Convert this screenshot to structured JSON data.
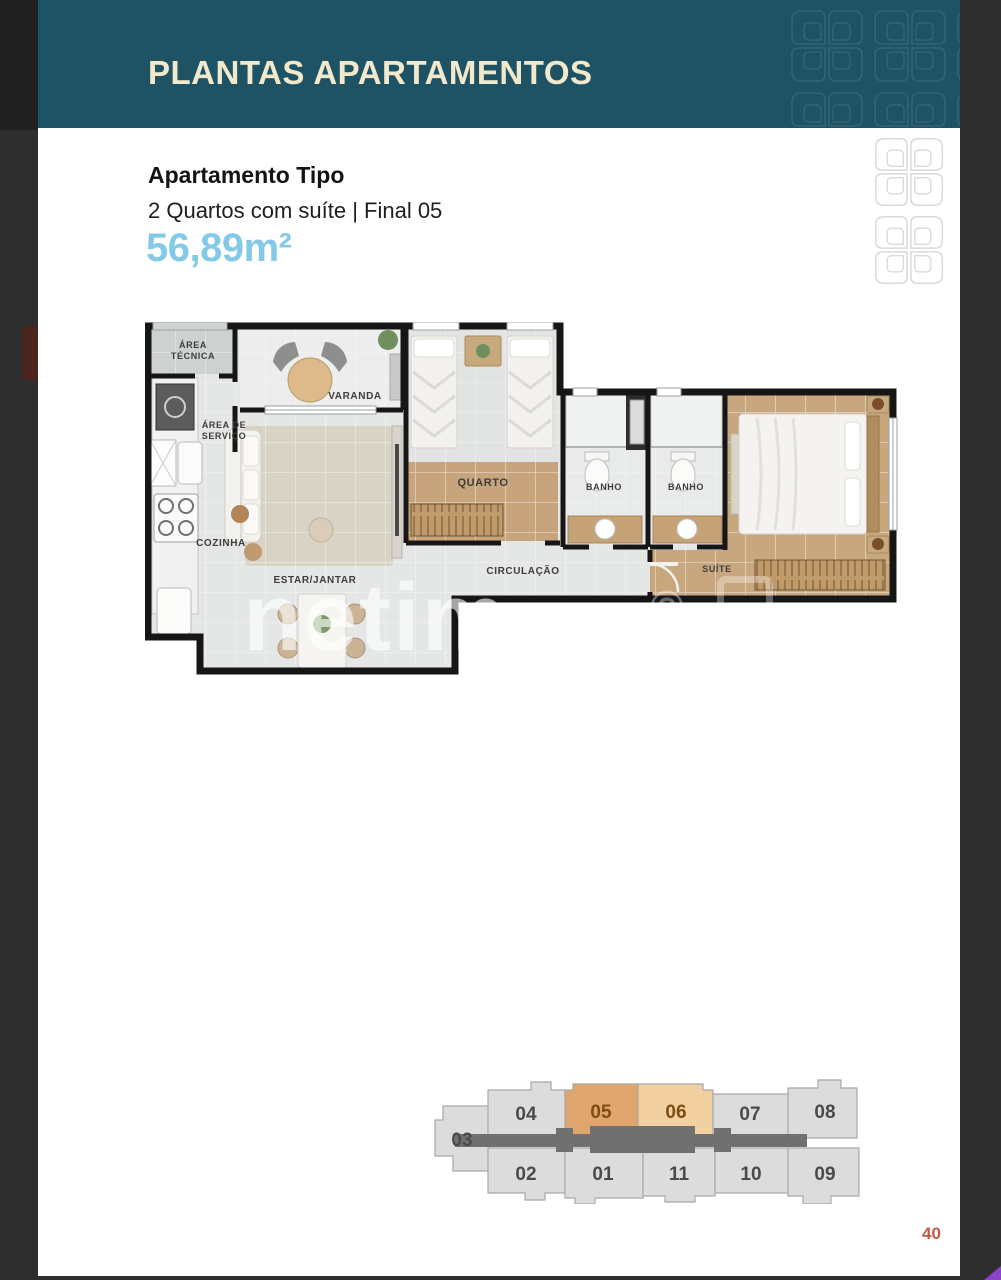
{
  "header": {
    "title": "PLANTAS APARTAMENTOS"
  },
  "apartment": {
    "type_label": "Apartamento Tipo",
    "description": "2 Quartos com suíte | Final 05",
    "area": "56,89m²"
  },
  "floor_plan": {
    "rooms": {
      "area_tecnica_line1": "ÁREA",
      "area_tecnica_line2": "TÉCNICA",
      "area_servico_line1": "ÁREA DE",
      "area_servico_line2": "SERVIÇO",
      "varanda": "VARANDA",
      "cozinha": "COZINHA",
      "estar_jantar": "ESTAR/JANTAR",
      "quarto": "QUARTO",
      "circulacao": "CIRCULAÇÃO",
      "banho_1": "BANHO",
      "banho_2": "BANHO",
      "suite": "SUÍTE"
    },
    "watermark": "netim",
    "copyright_mark": "©"
  },
  "key_plan": {
    "highlighted_unit": "05",
    "secondary_highlight": "06",
    "units": {
      "u01": "01",
      "u02": "02",
      "u03": "03",
      "u04": "04",
      "u05": "05",
      "u06": "06",
      "u07": "07",
      "u08": "08",
      "u09": "09",
      "u10": "10",
      "u11": "11"
    }
  },
  "page_number": "40",
  "colors": {
    "header_teal": "#1d5364",
    "title_cream": "#f2e9cc",
    "area_blue": "#85c9e8",
    "highlight_orange": "#e0a56c",
    "highlight_peach": "#f2d0a2",
    "page_number_orange": "#c2574b"
  }
}
